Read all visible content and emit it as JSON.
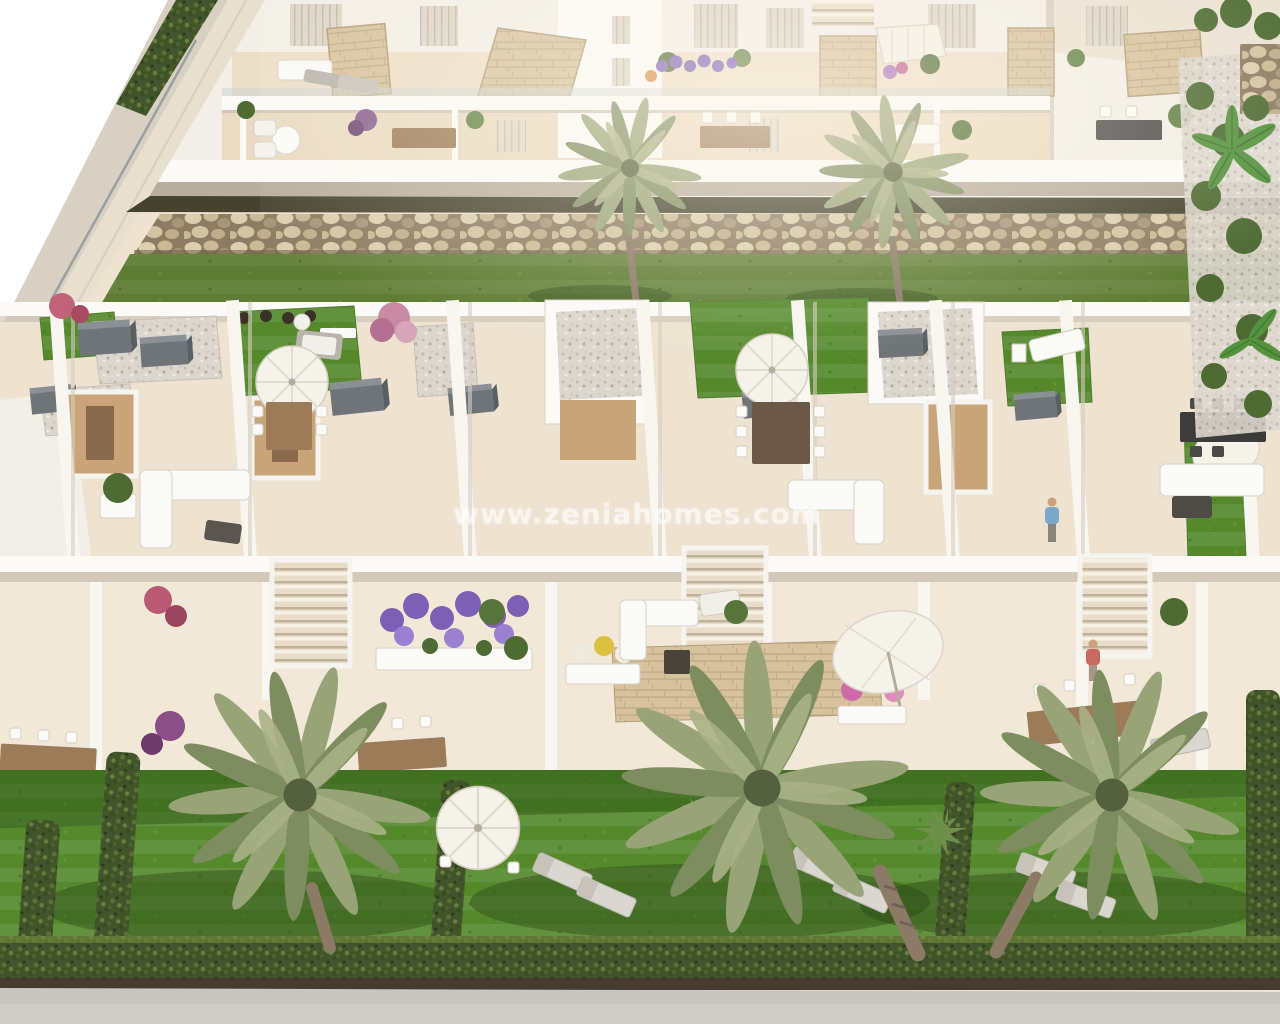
{
  "watermark": {
    "text": "www.zeniahomes.com",
    "color": "#ffffff",
    "opacity": 0.55
  },
  "palette": {
    "sky": "#ffffff",
    "building_white": "#f2efe8",
    "wall_shadow": "#ddd5c7",
    "slab_white": "#fbfaf7",
    "deck": "#eee3d1",
    "deck_light": "#f2e8d8",
    "stone_clad": "#d6c29c",
    "gravel": "#dcd7ce",
    "rock_wall": "#b2a284",
    "lawn_strip": "#5e7c33",
    "garden_lawn": "#55892c",
    "hedge": "#42542a",
    "palm_frond": "#93a075",
    "palm_trunk": "#8a7a66",
    "wood_furniture": "#9c7c58",
    "wood_floor": "#c9a478",
    "ac_unit": "#6e7477",
    "white_furniture": "#fafaf8",
    "umbrella": "#f5f2ea",
    "flower_purple": "#7d5fb5",
    "flower_pink": "#d069a8",
    "road": "#c9c5c0",
    "soil": "#453c2f"
  }
}
